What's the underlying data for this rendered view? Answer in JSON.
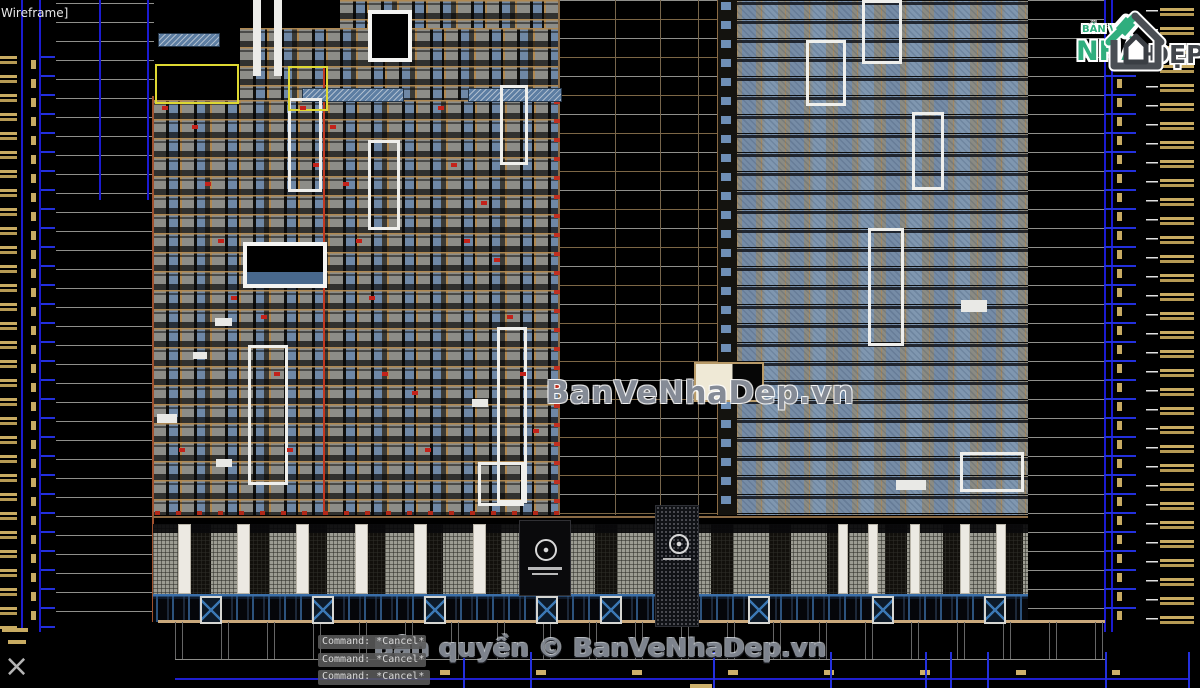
{
  "viewport": {
    "view_label": "Wireframe]",
    "background_color": "#000000",
    "content": "AutoCAD model space showing front elevation drawings of two high-rise apartment towers above a shared retail podium, with blue dimension lines and yellow level annotations on the left, right and bottom margins"
  },
  "drawing": {
    "type": "architectural-elevation",
    "accent_colors": {
      "tan_frame": "#b08850",
      "window_blue": "#6f8fb5",
      "red_accent": "#c0281c",
      "dimension_blue": "#2330dd",
      "annotation_yellow": "#c8ab62",
      "highlight_white": "#efefec",
      "highlight_yellow": "#ded832",
      "ground_line": "#c9a87c"
    }
  },
  "watermark": {
    "center_text": "BanVeNhaDep.vn",
    "copyright_text": "Bản quyền © BanVeNhaDep.vn"
  },
  "command_panel": {
    "lines": [
      "Command: *Cancel*",
      "Command: *Cancel*",
      "Command: *Cancel*"
    ]
  },
  "logo": {
    "top_text": "BẢN VẼ",
    "main_text": "NHÀ",
    "suffix_text": "ĐẸP",
    "icon": "house-icon",
    "green": "#2fae7e",
    "dark": "#42464c"
  },
  "cursor": {
    "glyph": "×"
  }
}
